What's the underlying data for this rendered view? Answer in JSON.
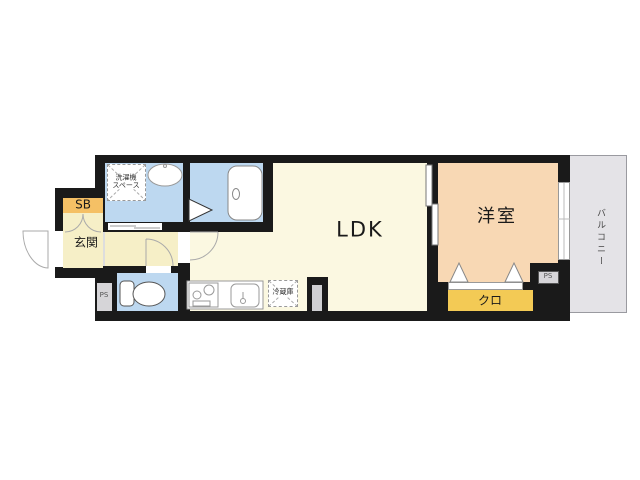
{
  "floorplan": {
    "type": "apartment-floor-plan-1K-LDK",
    "rooms": {
      "ldk": "LDK",
      "western_room": "洋室",
      "entrance": "玄関",
      "closet": "クロ",
      "shoe_box": "SB",
      "balcony": "バルコニー"
    },
    "fixtures": {
      "washer_space_line1": "洗濯機",
      "washer_space_line2": "スペース",
      "refrigerator": "冷蔵庫",
      "pipe_space_left": "PS",
      "pipe_space_right": "PS"
    },
    "colors": {
      "wall": "#1a1a1a",
      "wet_area_blue": "#bdd8f0",
      "ldk_cream": "#fbf8e1",
      "hall_cream": "#f6efc7",
      "bedroom_peach": "#f8d8b4",
      "closet_yellow": "#f3ca55",
      "shoe_box_orange": "#f5c065",
      "balcony_gray": "#e4e3e7",
      "pipe_space_gray": "#d6d5d8"
    }
  }
}
